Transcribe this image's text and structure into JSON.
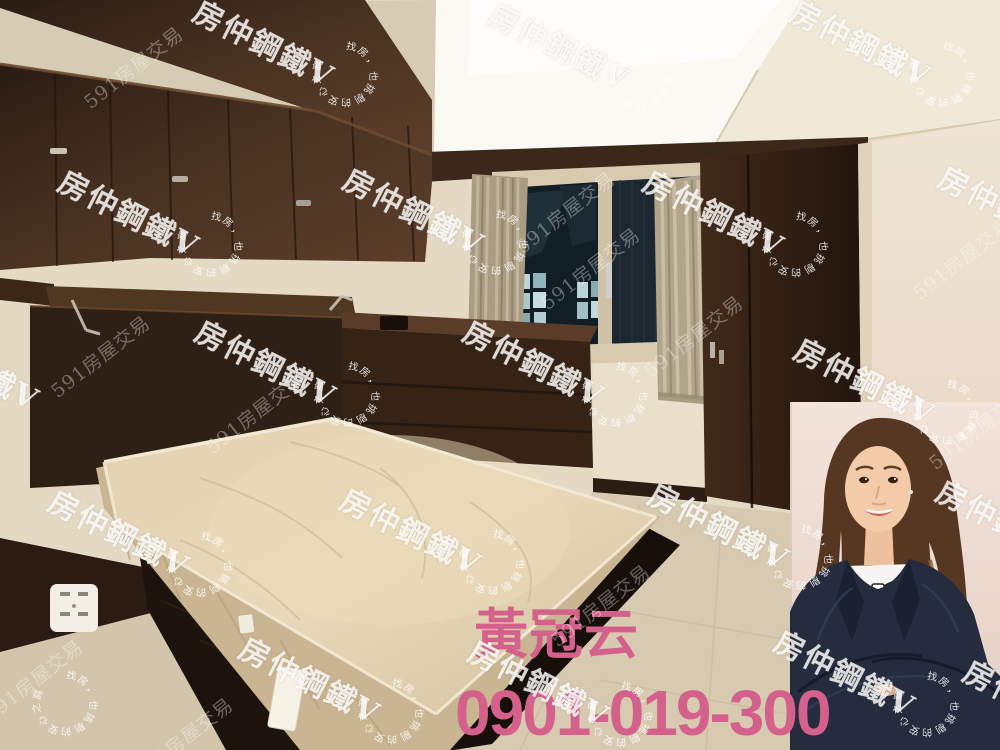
{
  "photo": {
    "scene": "bedroom listing photo",
    "elements": [
      "dark wood overhead cabinets",
      "storage headboard with open lid",
      "bare mattress on dark bed base",
      "chest of drawers",
      "window with dark night view",
      "beige curtains",
      "tall dark wardrobe",
      "wall power outlet",
      "light tile floor"
    ]
  },
  "agent": {
    "name": "黃冠云",
    "phone": "0901-019-300",
    "portrait": "female agent, dark suit, white bow blouse, arms crossed"
  },
  "watermarks": {
    "brand": "房仲鋼鐵V",
    "site": "591房屋交易",
    "arc": "找房，也挑剔的安心之窩"
  },
  "colors": {
    "overlay_text": "#d4618c",
    "watermark_text": "#ffffff",
    "wood_dark": "#33241b",
    "wall": "#e4dac4",
    "mattress": "#dcc9a6",
    "suit": "#242c3e",
    "floor": "#d7cab0"
  }
}
